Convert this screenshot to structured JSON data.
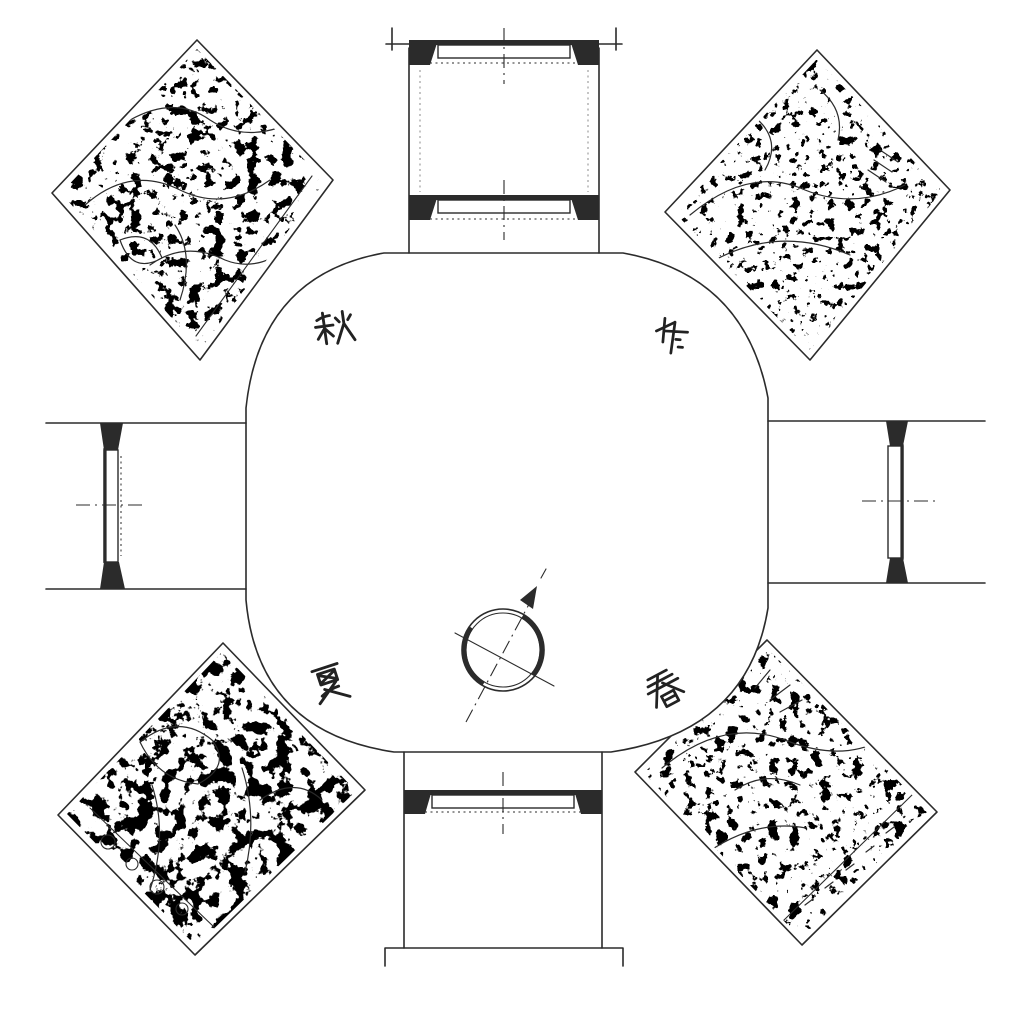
{
  "figure": {
    "ink_color": "#2b2b2b",
    "paper_color": "#ffffff",
    "season_labels": {
      "northwest": "秋",
      "northeast": "冬",
      "southwest": "夏",
      "southeast": "春"
    }
  }
}
